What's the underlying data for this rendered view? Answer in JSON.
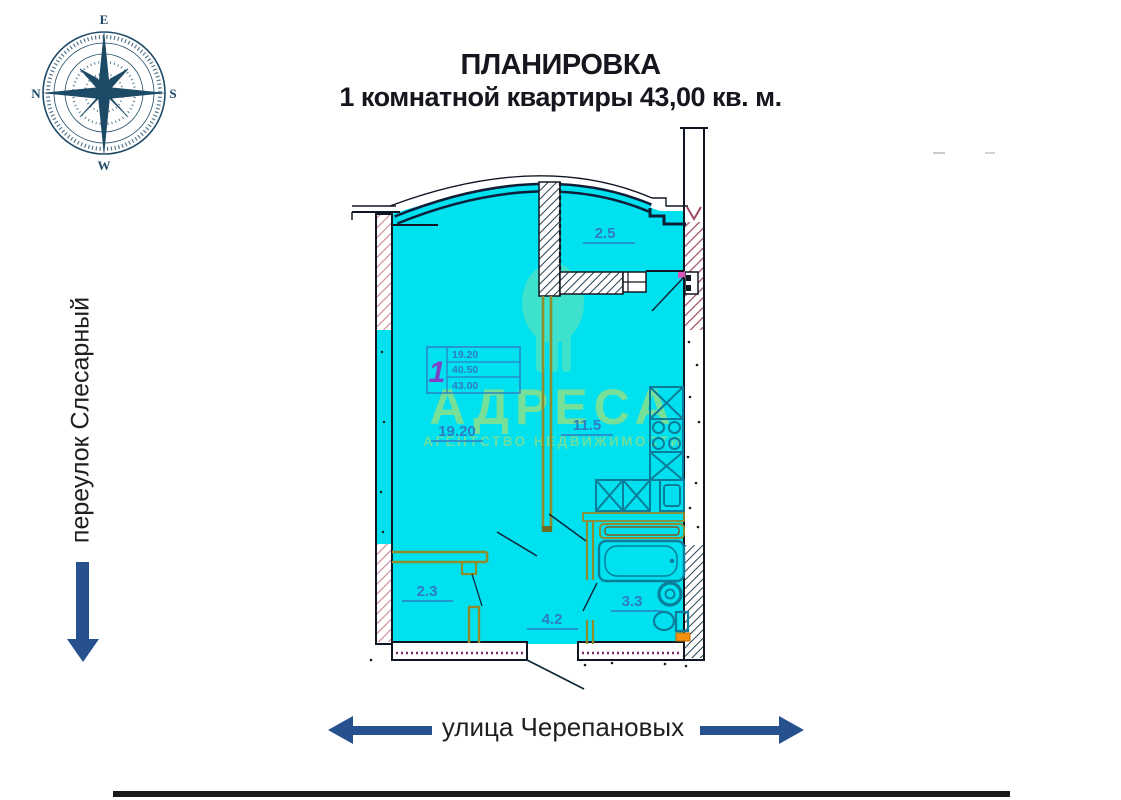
{
  "page": {
    "title_line1": "ПЛАНИРОВКА",
    "title_line2": "1 комнатной квартиры 43,00 кв. м."
  },
  "streets": {
    "left_label": "переулок Слесарный",
    "bottom_label": "улица Черепановых"
  },
  "compass": {
    "top": "E",
    "right": "S",
    "bottom": "W",
    "left": "N"
  },
  "plan": {
    "rooms": [
      {
        "id": "balcony",
        "area_label": "2.5"
      },
      {
        "id": "living-room",
        "area_label": "19.20"
      },
      {
        "id": "kitchen",
        "area_label": "11.5"
      },
      {
        "id": "wardrobe",
        "area_label": "2.3"
      },
      {
        "id": "hallway",
        "area_label": "4.2"
      },
      {
        "id": "bathroom",
        "area_label": "3.3"
      }
    ],
    "stamp": {
      "rooms_count": "1",
      "row1": "19.20",
      "row2": "40.50",
      "row3": "43.00"
    }
  },
  "watermark": {
    "brand": "АДРЕСА",
    "subtitle": "АГЕНТСТВО НЕДВИЖИМОСТИ"
  },
  "colors": {
    "plan_fill": "#00E1EF",
    "wall_dark": "#101C2E",
    "accent_arrow": "#27508F",
    "label_blue": "#2E7CC4",
    "partition_olive": "#8F8C2E",
    "fixture_teal": "#0B7D9B",
    "hatch_maroon": "#9C4A66",
    "watermark_yellow": "#D8DE52",
    "stamp_purple": "#7F3FC8",
    "orange_detail": "#F5920F"
  }
}
